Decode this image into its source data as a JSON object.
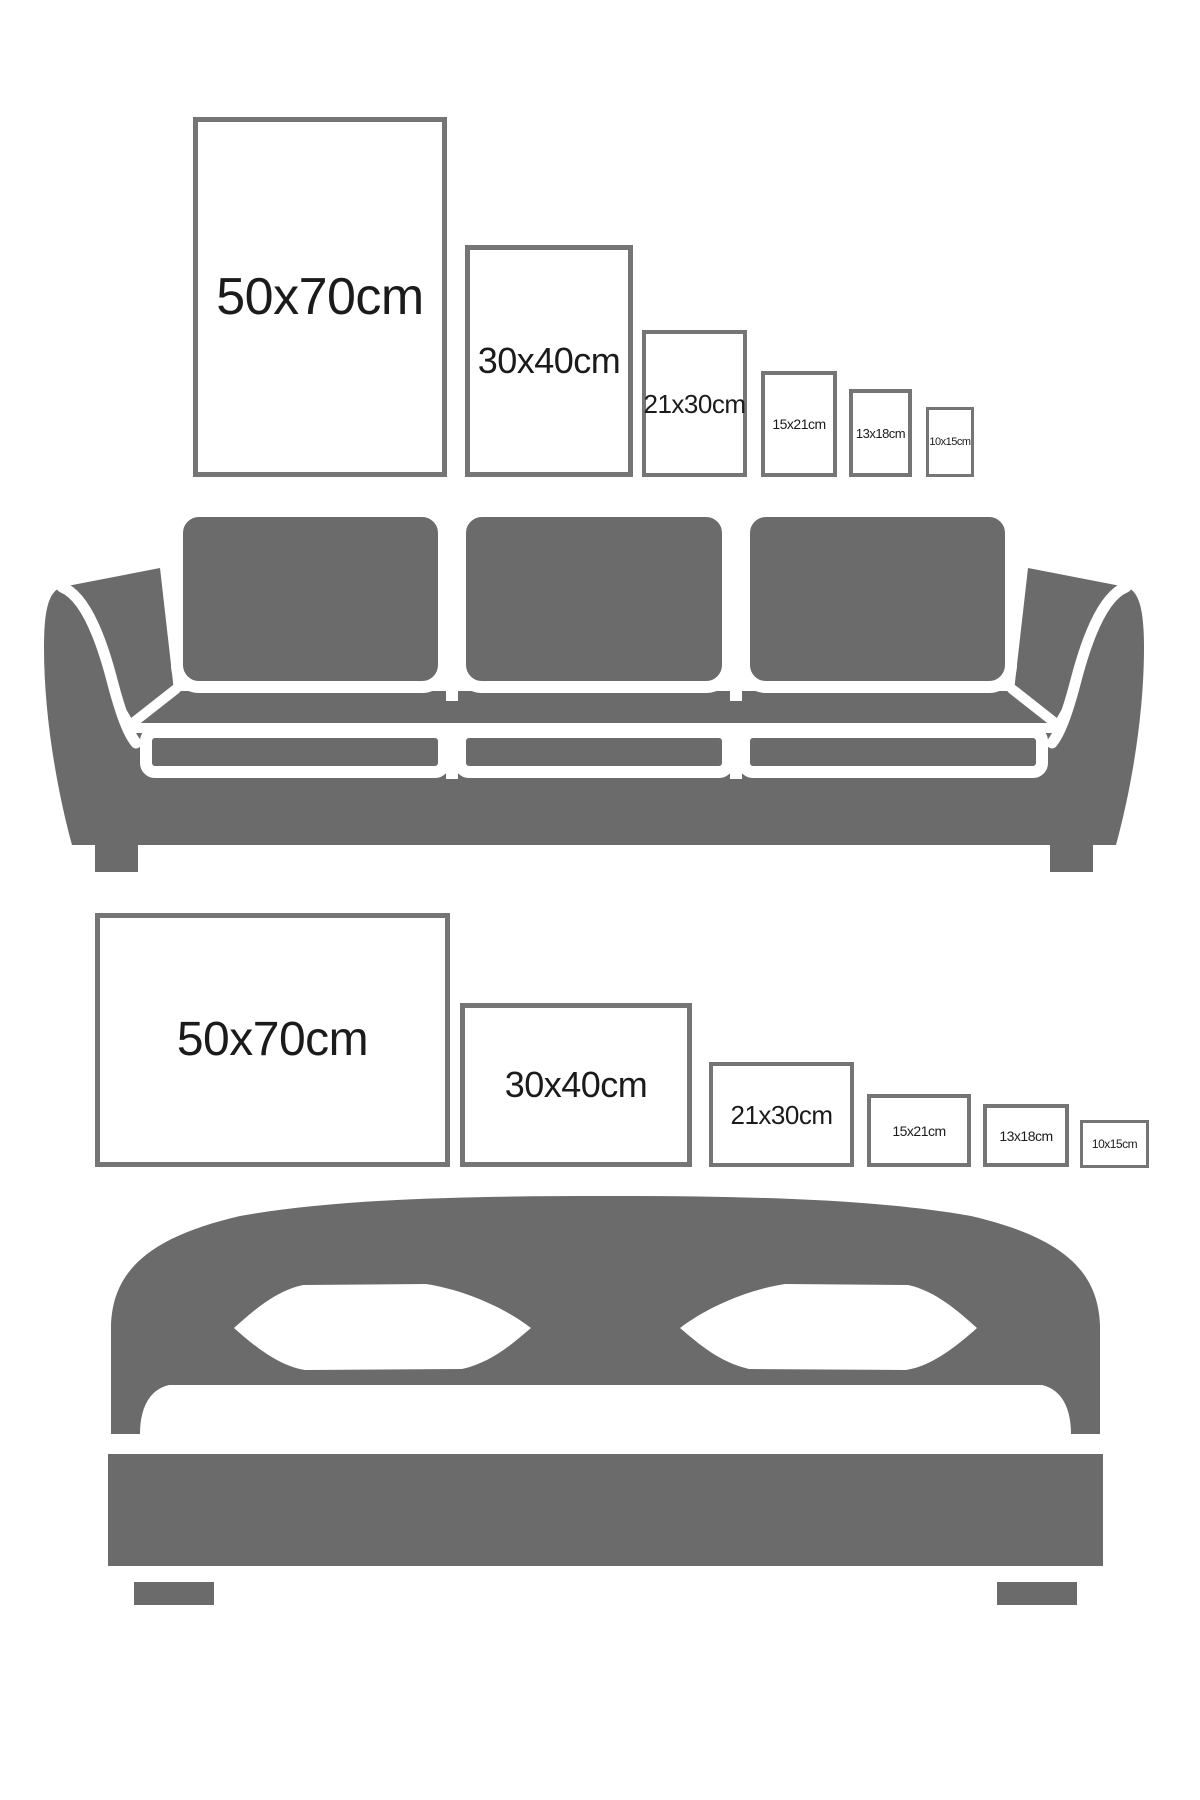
{
  "colors": {
    "background": "#ffffff",
    "furniture_gray": "#6b6b6b",
    "frame_border": "#757575",
    "label_text": "#1b1b1b"
  },
  "sofa_section": {
    "furniture": "sofa",
    "orientation": "portrait",
    "frames": [
      {
        "size": "50x70cm"
      },
      {
        "size": "30x40cm"
      },
      {
        "size": "21x30cm"
      },
      {
        "size": "15x21cm"
      },
      {
        "size": "13x18cm"
      },
      {
        "size": "10x15cm"
      }
    ]
  },
  "bed_section": {
    "furniture": "bed",
    "orientation": "landscape",
    "frames": [
      {
        "size": "50x70cm"
      },
      {
        "size": "30x40cm"
      },
      {
        "size": "21x30cm"
      },
      {
        "size": "15x21cm"
      },
      {
        "size": "13x18cm"
      },
      {
        "size": "10x15cm"
      }
    ]
  }
}
